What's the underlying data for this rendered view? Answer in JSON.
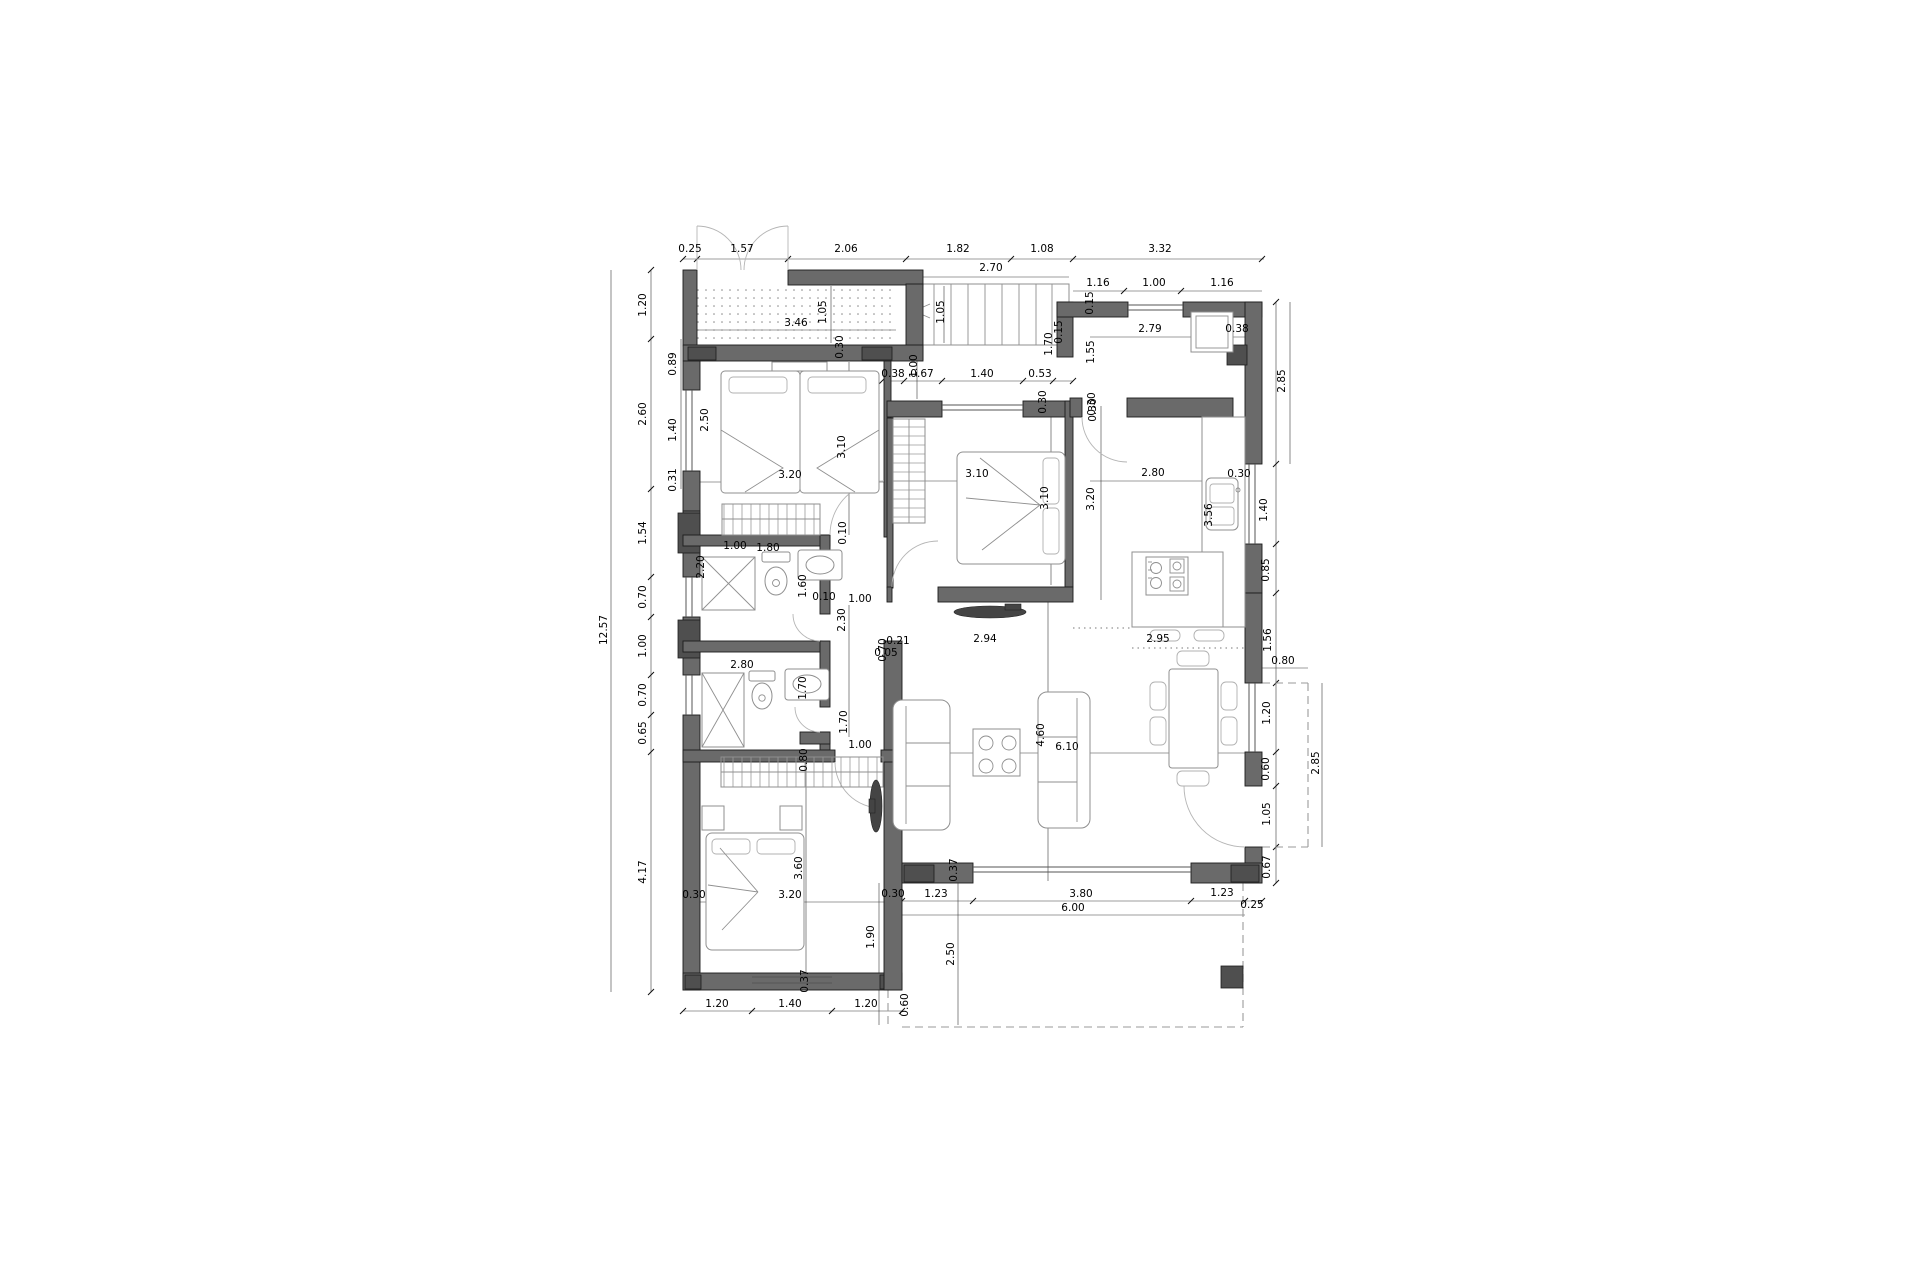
{
  "meta": {
    "type": "architectural-floor-plan",
    "units": "meters"
  },
  "colors": {
    "background": "#ffffff",
    "wall": "#6a6a6a",
    "pillar": "#4f4f4f",
    "dimension_line": "#3a3a3a",
    "furniture_line": "#8f8f8f",
    "dashed_outline": "#9a9a9a",
    "label_text": "#000000"
  },
  "icons": [
    "bed-icon",
    "wardrobe-icon",
    "shower-icon",
    "toilet-icon",
    "sink-icon",
    "sofa-icon",
    "coffee-table-icon",
    "dining-table-icon",
    "tv-icon",
    "fridge-icon",
    "cooktop-icon",
    "stool-icon",
    "stairs-icon",
    "door-swing-icon"
  ],
  "dimensions": [
    {
      "t": "0.25",
      "x": 690,
      "y": 252,
      "r": 0
    },
    {
      "t": "1.57",
      "x": 742,
      "y": 252,
      "r": 0
    },
    {
      "t": "2.06",
      "x": 846,
      "y": 252,
      "r": 0
    },
    {
      "t": "1.82",
      "x": 958,
      "y": 252,
      "r": 0
    },
    {
      "t": "1.08",
      "x": 1042,
      "y": 252,
      "r": 0
    },
    {
      "t": "3.32",
      "x": 1160,
      "y": 252,
      "r": 0
    },
    {
      "t": "2.70",
      "x": 991,
      "y": 271,
      "r": 0
    },
    {
      "t": "1.16",
      "x": 1098,
      "y": 286,
      "r": 0
    },
    {
      "t": "1.00",
      "x": 1154,
      "y": 286,
      "r": 0
    },
    {
      "t": "1.16",
      "x": 1222,
      "y": 286,
      "r": 0
    },
    {
      "t": "3.46",
      "x": 796,
      "y": 326,
      "r": 0
    },
    {
      "t": "1.05",
      "x": 826,
      "y": 312,
      "r": 1
    },
    {
      "t": "1.05",
      "x": 944,
      "y": 312,
      "r": 1
    },
    {
      "t": "0.30",
      "x": 843,
      "y": 347,
      "r": 1
    },
    {
      "t": "12.57",
      "x": 607,
      "y": 630,
      "r": 1
    },
    {
      "t": "1.20",
      "x": 646,
      "y": 305,
      "r": 1
    },
    {
      "t": "2.60",
      "x": 646,
      "y": 414,
      "r": 1
    },
    {
      "t": "1.54",
      "x": 646,
      "y": 533,
      "r": 1
    },
    {
      "t": "0.70",
      "x": 646,
      "y": 597,
      "r": 1
    },
    {
      "t": "1.00",
      "x": 646,
      "y": 646,
      "r": 1
    },
    {
      "t": "0.70",
      "x": 646,
      "y": 695,
      "r": 1
    },
    {
      "t": "0.65",
      "x": 646,
      "y": 733,
      "r": 1
    },
    {
      "t": "4.17",
      "x": 646,
      "y": 872,
      "r": 1
    },
    {
      "t": "0.89",
      "x": 676,
      "y": 364,
      "r": 1
    },
    {
      "t": "1.40",
      "x": 676,
      "y": 430,
      "r": 1
    },
    {
      "t": "0.31",
      "x": 676,
      "y": 480,
      "r": 1
    },
    {
      "t": "2.50",
      "x": 708,
      "y": 420,
      "r": 1
    },
    {
      "t": "3.20",
      "x": 790,
      "y": 478,
      "r": 0
    },
    {
      "t": "3.10",
      "x": 845,
      "y": 447,
      "r": 1
    },
    {
      "t": "1.00",
      "x": 735,
      "y": 549,
      "r": 0
    },
    {
      "t": "2.20",
      "x": 704,
      "y": 567,
      "r": 1
    },
    {
      "t": "1.80",
      "x": 768,
      "y": 551,
      "r": 0
    },
    {
      "t": "1.60",
      "x": 806,
      "y": 586,
      "r": 1
    },
    {
      "t": "0.10",
      "x": 846,
      "y": 533,
      "r": 1
    },
    {
      "t": "0.10",
      "x": 824,
      "y": 600,
      "r": 0
    },
    {
      "t": "1.00",
      "x": 860,
      "y": 602,
      "r": 0
    },
    {
      "t": "2.30",
      "x": 845,
      "y": 620,
      "r": 1
    },
    {
      "t": "0.70",
      "x": 886,
      "y": 650,
      "r": 1
    },
    {
      "t": "1.70",
      "x": 847,
      "y": 722,
      "r": 1
    },
    {
      "t": "0.80",
      "x": 807,
      "y": 760,
      "r": 1
    },
    {
      "t": "1.00",
      "x": 860,
      "y": 748,
      "r": 0
    },
    {
      "t": "2.80",
      "x": 742,
      "y": 668,
      "r": 0
    },
    {
      "t": "1.70",
      "x": 806,
      "y": 688,
      "r": 1
    },
    {
      "t": "0.38",
      "x": 893,
      "y": 377,
      "r": 0
    },
    {
      "t": "0.67",
      "x": 922,
      "y": 377,
      "r": 0
    },
    {
      "t": "1.40",
      "x": 982,
      "y": 377,
      "r": 0
    },
    {
      "t": "0.53",
      "x": 1040,
      "y": 377,
      "r": 0
    },
    {
      "t": "1.00",
      "x": 917,
      "y": 366,
      "r": 1
    },
    {
      "t": "0.30",
      "x": 1046,
      "y": 402,
      "r": 1
    },
    {
      "t": "0.30",
      "x": 1095,
      "y": 404,
      "r": 1
    },
    {
      "t": "3.10",
      "x": 977,
      "y": 477,
      "r": 0
    },
    {
      "t": "3.10",
      "x": 1048,
      "y": 498,
      "r": 1
    },
    {
      "t": "3.20",
      "x": 1094,
      "y": 499,
      "r": 1
    },
    {
      "t": "2.94",
      "x": 985,
      "y": 642,
      "r": 0
    },
    {
      "t": "0.21",
      "x": 898,
      "y": 644,
      "r": 0
    },
    {
      "t": "0.05",
      "x": 886,
      "y": 656,
      "r": 0
    },
    {
      "t": "1.70",
      "x": 1052,
      "y": 344,
      "r": 1
    },
    {
      "t": "1.55",
      "x": 1094,
      "y": 352,
      "r": 1
    },
    {
      "t": "0.15",
      "x": 1093,
      "y": 303,
      "r": 1
    },
    {
      "t": "0.15",
      "x": 1062,
      "y": 332,
      "r": 1
    },
    {
      "t": "2.79",
      "x": 1150,
      "y": 332,
      "r": 0
    },
    {
      "t": "0.38",
      "x": 1237,
      "y": 332,
      "r": 0
    },
    {
      "t": "0.30",
      "x": 1096,
      "y": 410,
      "r": 1
    },
    {
      "t": "2.80",
      "x": 1153,
      "y": 476,
      "r": 0
    },
    {
      "t": "0.30",
      "x": 1239,
      "y": 477,
      "r": 0
    },
    {
      "t": "3.56",
      "x": 1212,
      "y": 515,
      "r": 1
    },
    {
      "t": "2.85",
      "x": 1285,
      "y": 381,
      "r": 1
    },
    {
      "t": "1.40",
      "x": 1267,
      "y": 510,
      "r": 1
    },
    {
      "t": "0.85",
      "x": 1269,
      "y": 570,
      "r": 1
    },
    {
      "t": "1.56",
      "x": 1271,
      "y": 640,
      "r": 1
    },
    {
      "t": "2.95",
      "x": 1158,
      "y": 642,
      "r": 0
    },
    {
      "t": "6.10",
      "x": 1067,
      "y": 750,
      "r": 0
    },
    {
      "t": "4.60",
      "x": 1044,
      "y": 735,
      "r": 1
    },
    {
      "t": "0.80",
      "x": 1283,
      "y": 664,
      "r": 0
    },
    {
      "t": "1.20",
      "x": 1270,
      "y": 713,
      "r": 1
    },
    {
      "t": "0.60",
      "x": 1269,
      "y": 769,
      "r": 1
    },
    {
      "t": "1.05",
      "x": 1270,
      "y": 814,
      "r": 1
    },
    {
      "t": "0.67",
      "x": 1270,
      "y": 867,
      "r": 1
    },
    {
      "t": "2.85",
      "x": 1319,
      "y": 763,
      "r": 1
    },
    {
      "t": "1.23",
      "x": 936,
      "y": 897,
      "r": 0
    },
    {
      "t": "3.80",
      "x": 1081,
      "y": 897,
      "r": 0
    },
    {
      "t": "1.23",
      "x": 1222,
      "y": 896,
      "r": 0
    },
    {
      "t": "6.00",
      "x": 1073,
      "y": 911,
      "r": 0
    },
    {
      "t": "0.25",
      "x": 1252,
      "y": 908,
      "r": 0
    },
    {
      "t": "0.30",
      "x": 893,
      "y": 897,
      "r": 0
    },
    {
      "t": "0.37",
      "x": 957,
      "y": 870,
      "r": 1
    },
    {
      "t": "1.90",
      "x": 874,
      "y": 937,
      "r": 1
    },
    {
      "t": "2.50",
      "x": 954,
      "y": 954,
      "r": 1
    },
    {
      "t": "0.60",
      "x": 908,
      "y": 1005,
      "r": 1
    },
    {
      "t": "0.30",
      "x": 694,
      "y": 898,
      "r": 0
    },
    {
      "t": "3.20",
      "x": 790,
      "y": 898,
      "r": 0
    },
    {
      "t": "3.60",
      "x": 802,
      "y": 868,
      "r": 1
    },
    {
      "t": "0.37",
      "x": 808,
      "y": 981,
      "r": 1
    },
    {
      "t": "1.20",
      "x": 717,
      "y": 1007,
      "r": 0
    },
    {
      "t": "1.40",
      "x": 790,
      "y": 1007,
      "r": 0
    },
    {
      "t": "1.20",
      "x": 866,
      "y": 1007,
      "r": 0
    }
  ],
  "dim_lines": [
    [
      611,
      270,
      611,
      992
    ],
    [
      651,
      270,
      651,
      992
    ],
    [
      681,
      339,
      681,
      489
    ],
    [
      683,
      259,
      1264,
      259
    ],
    [
      914,
      277,
      1069,
      277
    ],
    [
      1073,
      291,
      1262,
      291
    ],
    [
      697,
      330,
      896,
      330
    ],
    [
      831,
      286,
      831,
      343
    ],
    [
      944,
      286,
      944,
      343
    ],
    [
      700,
      482,
      884,
      482
    ],
    [
      849,
      362,
      849,
      535
    ],
    [
      892,
      481,
      1065,
      481
    ],
    [
      1051,
      406,
      1051,
      585
    ],
    [
      887,
      381,
      1073,
      381
    ],
    [
      917,
      347,
      917,
      399
    ],
    [
      683,
      902,
      902,
      902
    ],
    [
      806,
      753,
      806,
      988
    ],
    [
      902,
      753,
      1245,
      753
    ],
    [
      1048,
      602,
      1048,
      881
    ],
    [
      1090,
      337,
      1245,
      337
    ],
    [
      1090,
      481,
      1245,
      481
    ],
    [
      1101,
      406,
      1101,
      600
    ],
    [
      1216,
      417,
      1216,
      627
    ],
    [
      1290,
      302,
      1290,
      464
    ],
    [
      1276,
      302,
      1276,
      883
    ],
    [
      902,
      901,
      1262,
      901
    ],
    [
      902,
      915,
      1245,
      915
    ],
    [
      683,
      1011,
      902,
      1011
    ],
    [
      879,
      883,
      879,
      1025
    ],
    [
      958,
      883,
      958,
      1025
    ],
    [
      1322,
      683,
      1322,
      847
    ],
    [
      1262,
      668,
      1308,
      668
    ],
    [
      849,
      605,
      849,
      737
    ]
  ],
  "tick_groups": [
    {
      "axis": "x",
      "fixed": 259,
      "at": [
        683,
        697,
        788,
        906,
        1011,
        1073,
        1262
      ]
    },
    {
      "axis": "y",
      "fixed": 651,
      "at": [
        270,
        339,
        489,
        577,
        617,
        675,
        715,
        752,
        992
      ]
    },
    {
      "axis": "x",
      "fixed": 901,
      "at": [
        902,
        973,
        1191,
        1245,
        1262
      ]
    },
    {
      "axis": "x",
      "fixed": 1011,
      "at": [
        683,
        752,
        832,
        902
      ]
    },
    {
      "axis": "y",
      "fixed": 1276,
      "at": [
        302,
        464,
        544,
        593,
        683,
        752,
        786,
        847,
        883
      ]
    },
    {
      "axis": "x",
      "fixed": 381,
      "at": [
        882,
        904,
        942,
        1023,
        1053,
        1073
      ]
    },
    {
      "axis": "x",
      "fixed": 291,
      "at": [
        1124,
        1181
      ]
    }
  ]
}
